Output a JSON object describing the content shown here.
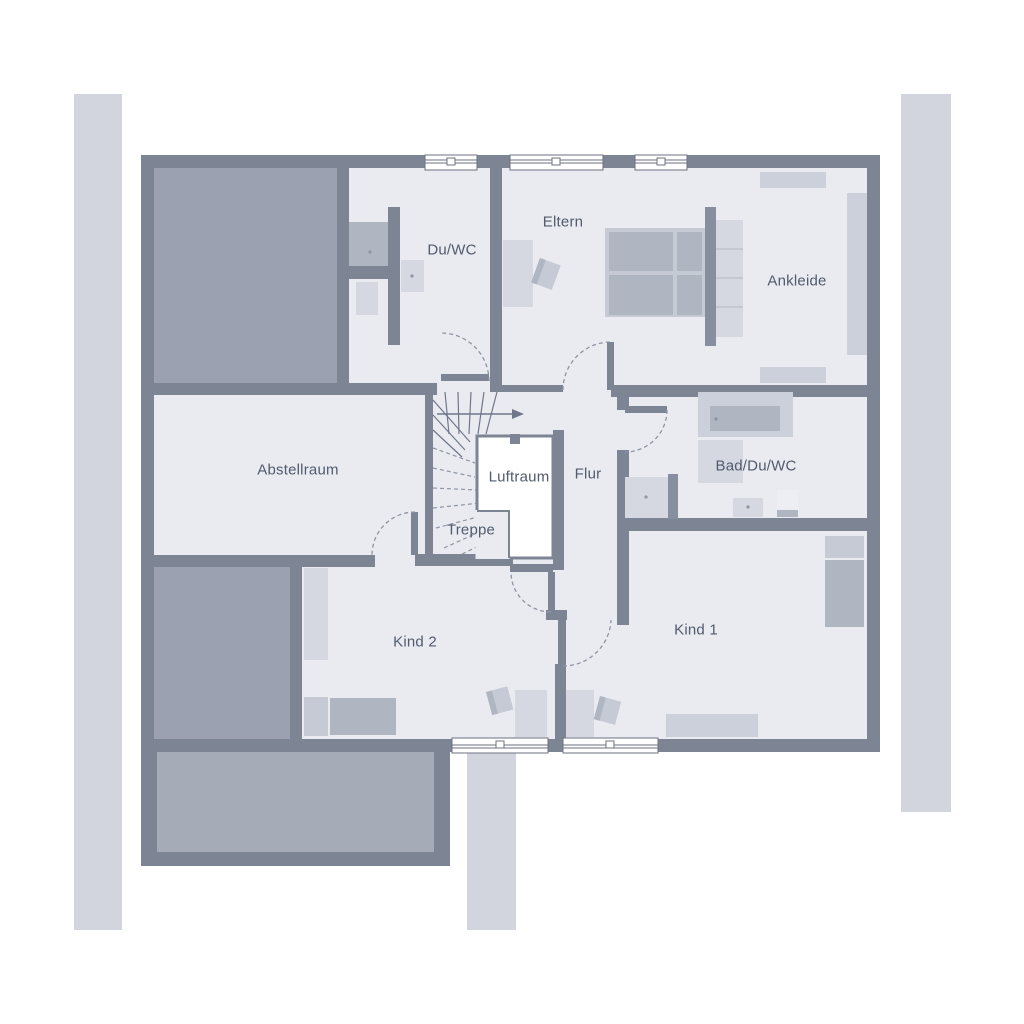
{
  "rooms": [
    {
      "id": "duwc",
      "label": "Du/WC"
    },
    {
      "id": "eltern",
      "label": "Eltern"
    },
    {
      "id": "ankleide",
      "label": "Ankleide"
    },
    {
      "id": "abstellraum",
      "label": "Abstellraum"
    },
    {
      "id": "luftraum",
      "label": "Luftraum"
    },
    {
      "id": "flur",
      "label": "Flur"
    },
    {
      "id": "treppe",
      "label": "Treppe"
    },
    {
      "id": "badduwc",
      "label": "Bad/Du/WC"
    },
    {
      "id": "kind1",
      "label": "Kind 1"
    },
    {
      "id": "kind2",
      "label": "Kind 2"
    }
  ],
  "colors": {
    "wall": "#7d8494",
    "wall_partition": "#878e9e",
    "floor": "#e9ebf1",
    "dark_area": "#9ba1b0",
    "dark_area_inner": "#a6abb8",
    "exterior_strip": "#d3d5de",
    "furniture_light": "#d5d8e1",
    "furniture_medium": "#b0b5c2",
    "furniture_soft": "#c6cad5",
    "furniture_shelf": "#ccd0da",
    "shelf_line": "#b9bec9",
    "line": "#6f7789",
    "dash": "#8e95a4",
    "window_line": "#6b7280",
    "label_text": "#515b6d"
  }
}
